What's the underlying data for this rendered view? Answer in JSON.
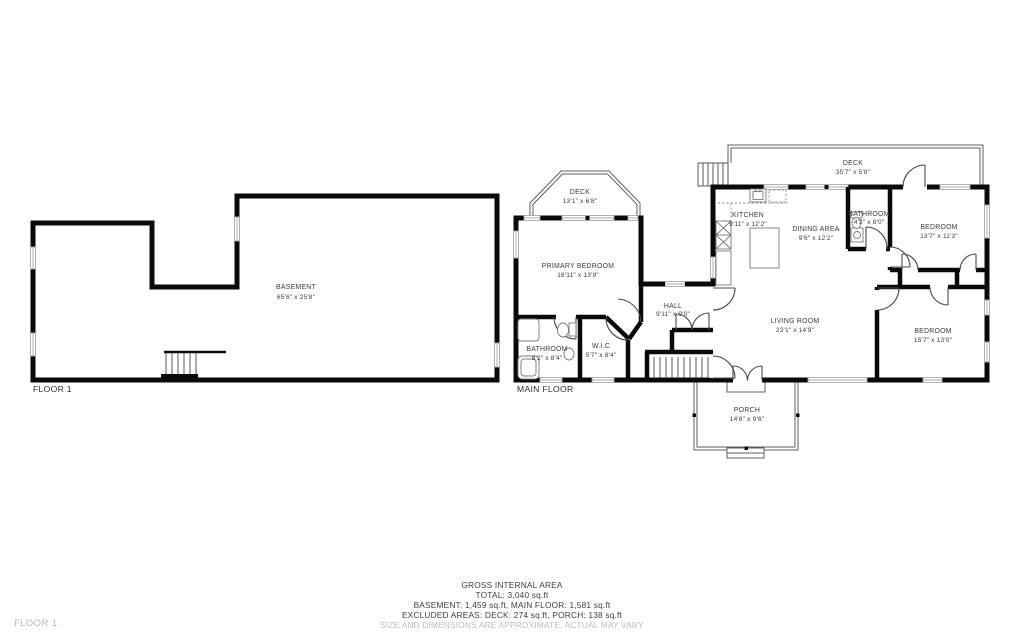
{
  "colors": {
    "wall": "#0a0a0a",
    "window_gray": "#a9a9a9",
    "muted_text": "#bdbdbd"
  },
  "floor_labels": {
    "basement": "FLOOR 1",
    "main": "MAIN FLOOR",
    "page_floor": "FLOOR 1"
  },
  "rooms": {
    "basement": {
      "name": "BASEMENT",
      "dims": "65'6\" x 25'8\""
    },
    "deck_left": {
      "name": "DECK",
      "dims": "13'1\" x 6'8\""
    },
    "primary_bedroom": {
      "name": "PRIMARY BEDROOM",
      "dims": "16'11\" x 13'9\""
    },
    "bathroom_left": {
      "name": "BATHROOM",
      "dims": "8'2\" x 8'4\""
    },
    "wic": {
      "name": "W.I.C",
      "dims": "5'7\" x 8'4\""
    },
    "hall": {
      "name": "HALL",
      "dims": "9'11\" x 9'0\""
    },
    "kitchen": {
      "name": "KITCHEN",
      "dims": "9'11\" x 12'2\""
    },
    "dining": {
      "name": "DINING AREA",
      "dims": "9'6\" x 12'2\""
    },
    "deck_right": {
      "name": "DECK",
      "dims": "35'7\" x 5'8\""
    },
    "bathroom_main": {
      "name": "BATHROOM",
      "dims": "4'2\" x 8'0\""
    },
    "bedroom_top": {
      "name": "BEDROOM",
      "dims": "13'7\" x 11'3\""
    },
    "living": {
      "name": "LIVING ROOM",
      "dims": "23'1\" x 14'9\""
    },
    "bedroom_bottom": {
      "name": "BEDROOM",
      "dims": "15'7\" x 13'0\""
    },
    "porch": {
      "name": "PORCH",
      "dims": "14'6\" x 9'6\""
    }
  },
  "footer": {
    "title": "GROSS INTERNAL AREA",
    "total": "TOTAL: 3,040 sq.ft",
    "breakdown": "BASEMENT: 1,459 sq.ft, MAIN FLOOR: 1,581 sq.ft",
    "excluded": "EXCLUDED AREAS: DECK: 274 sq.ft, PORCH: 138 sq.ft",
    "disclaimer": "SIZE AND DIMENSIONS ARE APPROXIMATE, ACTUAL MAY VARY"
  }
}
